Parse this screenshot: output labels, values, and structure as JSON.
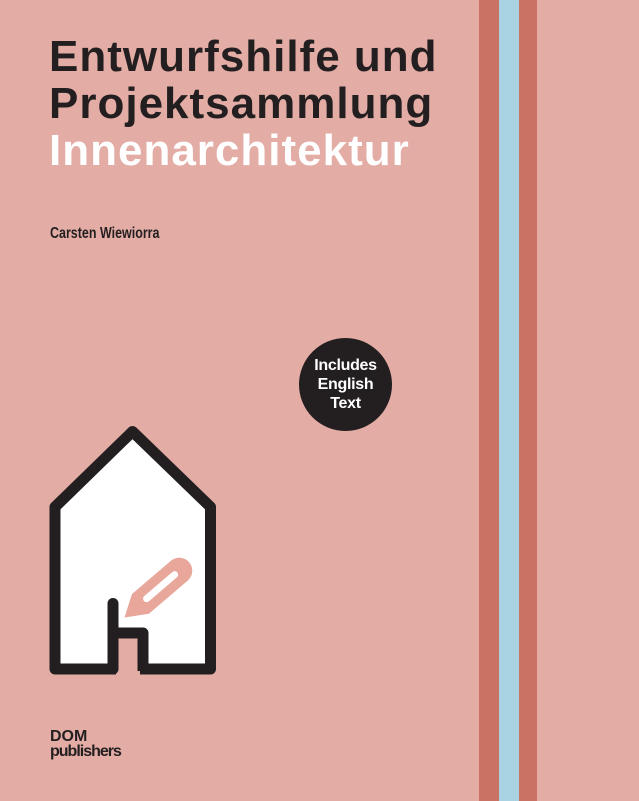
{
  "cover": {
    "title_line1": "Entwurfshilfe und",
    "title_line2": "Projektsammlung",
    "subtitle": "Innenarchitektur",
    "author": "Carsten Wiewiorra",
    "badge": {
      "line1": "Includes",
      "line2": "English",
      "line3": "Text"
    },
    "publisher": {
      "line1": "DOM",
      "line2": "publishers"
    },
    "colors": {
      "background": "#e3aca5",
      "title_primary": "#231f20",
      "subtitle": "#ffffff",
      "badge_background": "#231f20",
      "badge_text": "#ffffff",
      "stripe_terracotta": "#ca7263",
      "stripe_blue": "#a9d3e2",
      "house_outline": "#231f20",
      "house_fill": "#ffffff",
      "pencil": "#e9a69a"
    }
  }
}
